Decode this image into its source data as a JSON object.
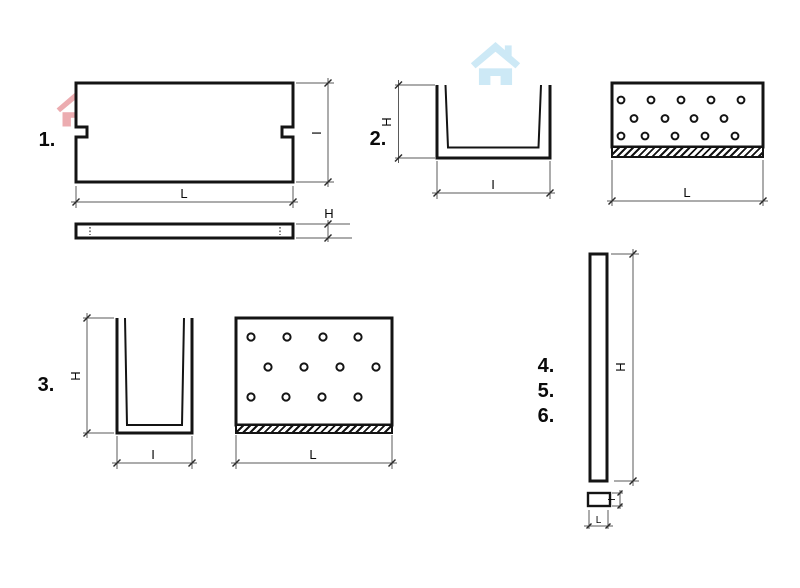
{
  "figures": {
    "fig1": {
      "number": "1.",
      "plan": {
        "length_label": "L",
        "width_label": "I"
      },
      "side": {
        "thickness_label": "H"
      }
    },
    "fig2": {
      "number": "2.",
      "section": {
        "height_label": "H",
        "width_label": "I"
      },
      "front": {
        "length_label": "L"
      }
    },
    "fig3": {
      "number": "3.",
      "section": {
        "height_label": "H",
        "width_label": "I"
      },
      "front": {
        "length_label": "L"
      }
    },
    "fig456": {
      "numbers": [
        "4.",
        "5.",
        "6."
      ],
      "front": {
        "height_label": "H"
      },
      "section": {
        "width_label": "L",
        "depth_label": "I"
      }
    }
  },
  "watermarks": {
    "icon": "house",
    "blue_color": "#cde9f6",
    "pink_color": "#ecacb0"
  },
  "canvas": {
    "background": "#ffffff",
    "line_color": "#141414",
    "dim_line_color": "#5a5a5a"
  }
}
